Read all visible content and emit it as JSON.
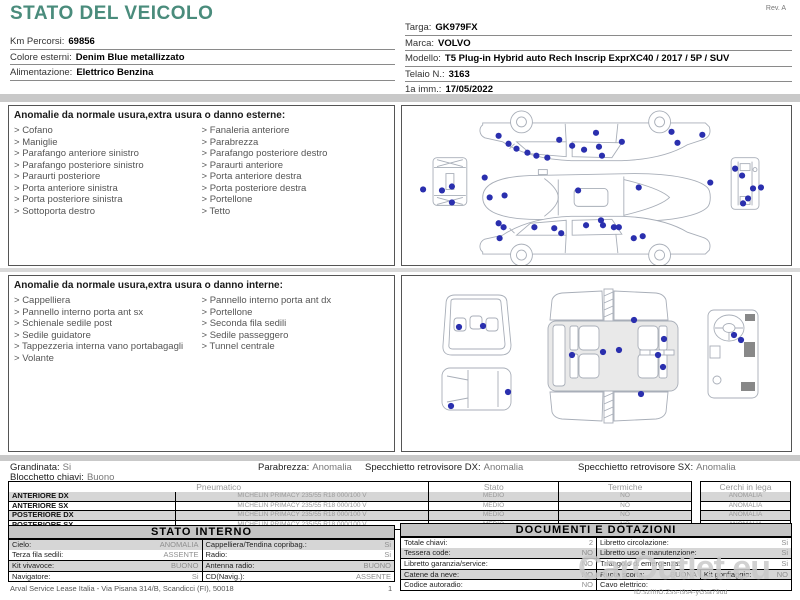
{
  "colors": {
    "accent": "#4a8c7c",
    "marker": "#2a2fae",
    "outline": "#a8aeb8",
    "bar": "#c9c9c9",
    "rowgray": "#d6d6d6",
    "valgray": "#8f8f8f",
    "wm": "#c9c9c9"
  },
  "header": {
    "title": "STATO DEL VEICOLO",
    "rev": "Rev. A",
    "left_fields": [
      {
        "label": "Km Percorsi:",
        "value": "69856"
      },
      {
        "label": "Colore esterni:",
        "value": "Denim Blue metallizzato"
      },
      {
        "label": "Alimentazione:",
        "value": "Elettrico Benzina"
      }
    ],
    "right_fields": [
      {
        "label": "Targa:",
        "value": "GK979FX"
      },
      {
        "label": "Marca:",
        "value": "VOLVO"
      },
      {
        "label": "Modello:",
        "value": "T5 Plug-in Hybrid auto Rech Inscrip ExprXC40 / 2017 / 5P / SUV"
      },
      {
        "label": "Telaio N.:",
        "value": "3163"
      },
      {
        "label": "1a imm.:",
        "value": "17/05/2022"
      }
    ]
  },
  "external_anomalies": {
    "title": "Anomalie da normale usura,extra usura o danno esterne:",
    "col1": [
      "Cofano",
      "Maniglie",
      "Parafango anteriore sinistro",
      "Parafango posteriore sinistro",
      "Paraurti posteriore",
      "Porta anteriore sinistra",
      "Porta posteriore sinistra",
      "Sottoporta destro"
    ],
    "col2": [
      "Fanaleria anteriore",
      "Parabrezza",
      "Parafango posteriore destro",
      "Paraurti anteriore",
      "Porta anteriore destra",
      "Porta posteriore destra",
      "Portellone",
      "Tetto"
    ]
  },
  "internal_anomalies": {
    "title": "Anomalie da normale usura,extra usura o danno interne:",
    "col1": [
      "Cappelliera",
      "Pannello interno porta ant sx",
      "Schienale sedile post",
      "Sedile guidatore",
      "Tappezzeria interna vano portabagagli",
      "Volante"
    ],
    "col2": [
      "Pannello interno porta ant dx",
      "Portellone",
      "Seconda fila sedili",
      "Sedile passeggero",
      "Tunnel centrale"
    ]
  },
  "status": {
    "grandinata": {
      "label": "Grandinata:",
      "value": "Si"
    },
    "parabrezza": {
      "label": "Parabrezza:",
      "value": "Anomalia"
    },
    "specchietto_dx": {
      "label": "Specchietto retrovisore DX:",
      "value": "Anomalia"
    },
    "specchietto_sx": {
      "label": "Specchietto retrovisore SX:",
      "value": "Anomalia"
    },
    "blocchetto": {
      "label": "Blocchetto chiavi:",
      "value": "Buono"
    }
  },
  "tires": {
    "header_pneumatico": "Pneumatico",
    "header_stato": "Stato",
    "header_termiche": "Termiche",
    "header_cerchi": "Cerchi in lega",
    "rows": [
      {
        "position": "ANTERIORE DX",
        "tire": "MICHELIN PRIMACY 235/55 R18 000/100 V",
        "stato": "MEDIO",
        "termiche": "NO",
        "cerchi": "ANOMALIA"
      },
      {
        "position": "ANTERIORE SX",
        "tire": "MICHELIN PRIMACY 235/55 R18 000/100 V",
        "stato": "MEDIO",
        "termiche": "NO",
        "cerchi": "ANOMALIA"
      },
      {
        "position": "POSTERIORE DX",
        "tire": "MICHELIN PRIMACY 235/55 R18 000/100 V",
        "stato": "MEDIO",
        "termiche": "NO",
        "cerchi": "ANOMALIA"
      },
      {
        "position": "POSTERIORE SX",
        "tire": "MICHELIN PRIMACY 235/55 R18 000/100 V",
        "stato": "MEDIO",
        "termiche": "NO",
        "cerchi": "ANOMALIA"
      }
    ]
  },
  "stato_interno": {
    "title": "STATO INTERNO",
    "rows": [
      {
        "l1": "Cielo:",
        "v1": "ANOMALIA",
        "l2": "Cappelliera/Tendina copribag.:",
        "v2": "Si"
      },
      {
        "l1": "Terza fila sedili:",
        "v1": "ASSENTE",
        "l2": "Radio:",
        "v2": "Si"
      },
      {
        "l1": "Kit vivavoce:",
        "v1": "BUONO",
        "l2": "Antenna radio:",
        "v2": "BUONO"
      },
      {
        "l1": "Navigatore:",
        "v1": "Si",
        "l2": "CD(Navig.):",
        "v2": "ASSENTE"
      }
    ]
  },
  "documenti": {
    "title": "DOCUMENTI E DOTAZIONI",
    "rows": [
      {
        "l1": "Totale chiavi:",
        "v1": "2",
        "l2": "Libretto circolazione:",
        "v2": "Si"
      },
      {
        "l1": "Tessera code:",
        "v1": "NO",
        "l2": "Libretto uso e manutenzione:",
        "v2": "Si"
      },
      {
        "l1": "Libretto garanzia/service:",
        "v1": "NO",
        "l2": "Triangolo di emergenza:",
        "v2": "Si"
      },
      {
        "l1": "Catene da neve:",
        "v1": "NO",
        "l2": "Ruota scorta:",
        "v2": "BUONA",
        "l3": "Kit gonfiaggio:",
        "v3": "NO"
      },
      {
        "l1": "Codice autoradio:",
        "v1": "NO",
        "l2": "Cavo elettrico:",
        "v2": ""
      }
    ]
  },
  "diagrams": {
    "exterior_dots": [
      [
        96,
        30
      ],
      [
        106,
        38
      ],
      [
        114,
        43
      ],
      [
        125,
        47
      ],
      [
        134,
        50
      ],
      [
        145,
        52
      ],
      [
        157,
        34
      ],
      [
        170,
        40
      ],
      [
        182,
        44
      ],
      [
        194,
        27
      ],
      [
        197,
        41
      ],
      [
        200,
        50
      ],
      [
        220,
        36
      ],
      [
        270,
        26
      ],
      [
        301,
        29
      ],
      [
        276,
        37
      ],
      [
        82,
        72
      ],
      [
        87,
        92
      ],
      [
        102,
        90
      ],
      [
        176,
        85
      ],
      [
        237,
        82
      ],
      [
        309,
        77
      ],
      [
        20,
        84
      ],
      [
        39,
        85
      ],
      [
        49,
        81
      ],
      [
        49,
        97
      ],
      [
        334,
        63
      ],
      [
        341,
        70
      ],
      [
        342,
        98
      ],
      [
        347,
        93
      ],
      [
        352,
        83
      ],
      [
        360,
        82
      ],
      [
        96,
        118
      ],
      [
        101,
        122
      ],
      [
        132,
        122
      ],
      [
        152,
        123
      ],
      [
        159,
        128
      ],
      [
        97,
        133
      ],
      [
        184,
        120
      ],
      [
        199,
        115
      ],
      [
        201,
        120
      ],
      [
        212,
        122
      ],
      [
        217,
        122
      ],
      [
        232,
        133
      ],
      [
        241,
        131
      ]
    ],
    "interior_dots": [
      [
        57,
        51
      ],
      [
        81,
        50
      ],
      [
        106,
        116
      ],
      [
        49,
        130
      ],
      [
        232,
        44
      ],
      [
        170,
        79
      ],
      [
        201,
        76
      ],
      [
        217,
        74
      ],
      [
        262,
        63
      ],
      [
        256,
        79
      ],
      [
        261,
        91
      ],
      [
        239,
        118
      ],
      [
        332,
        59
      ],
      [
        339,
        64
      ]
    ]
  },
  "footer": {
    "address": "Arval Service Lease Italia - Via Pisana 314/B, Scandicci (FI), 50018",
    "page": "1",
    "watermark": "CarOutlet.eu",
    "doc_id": "ID:szfIhO.Zss-t9s4-yGsa79ud"
  }
}
